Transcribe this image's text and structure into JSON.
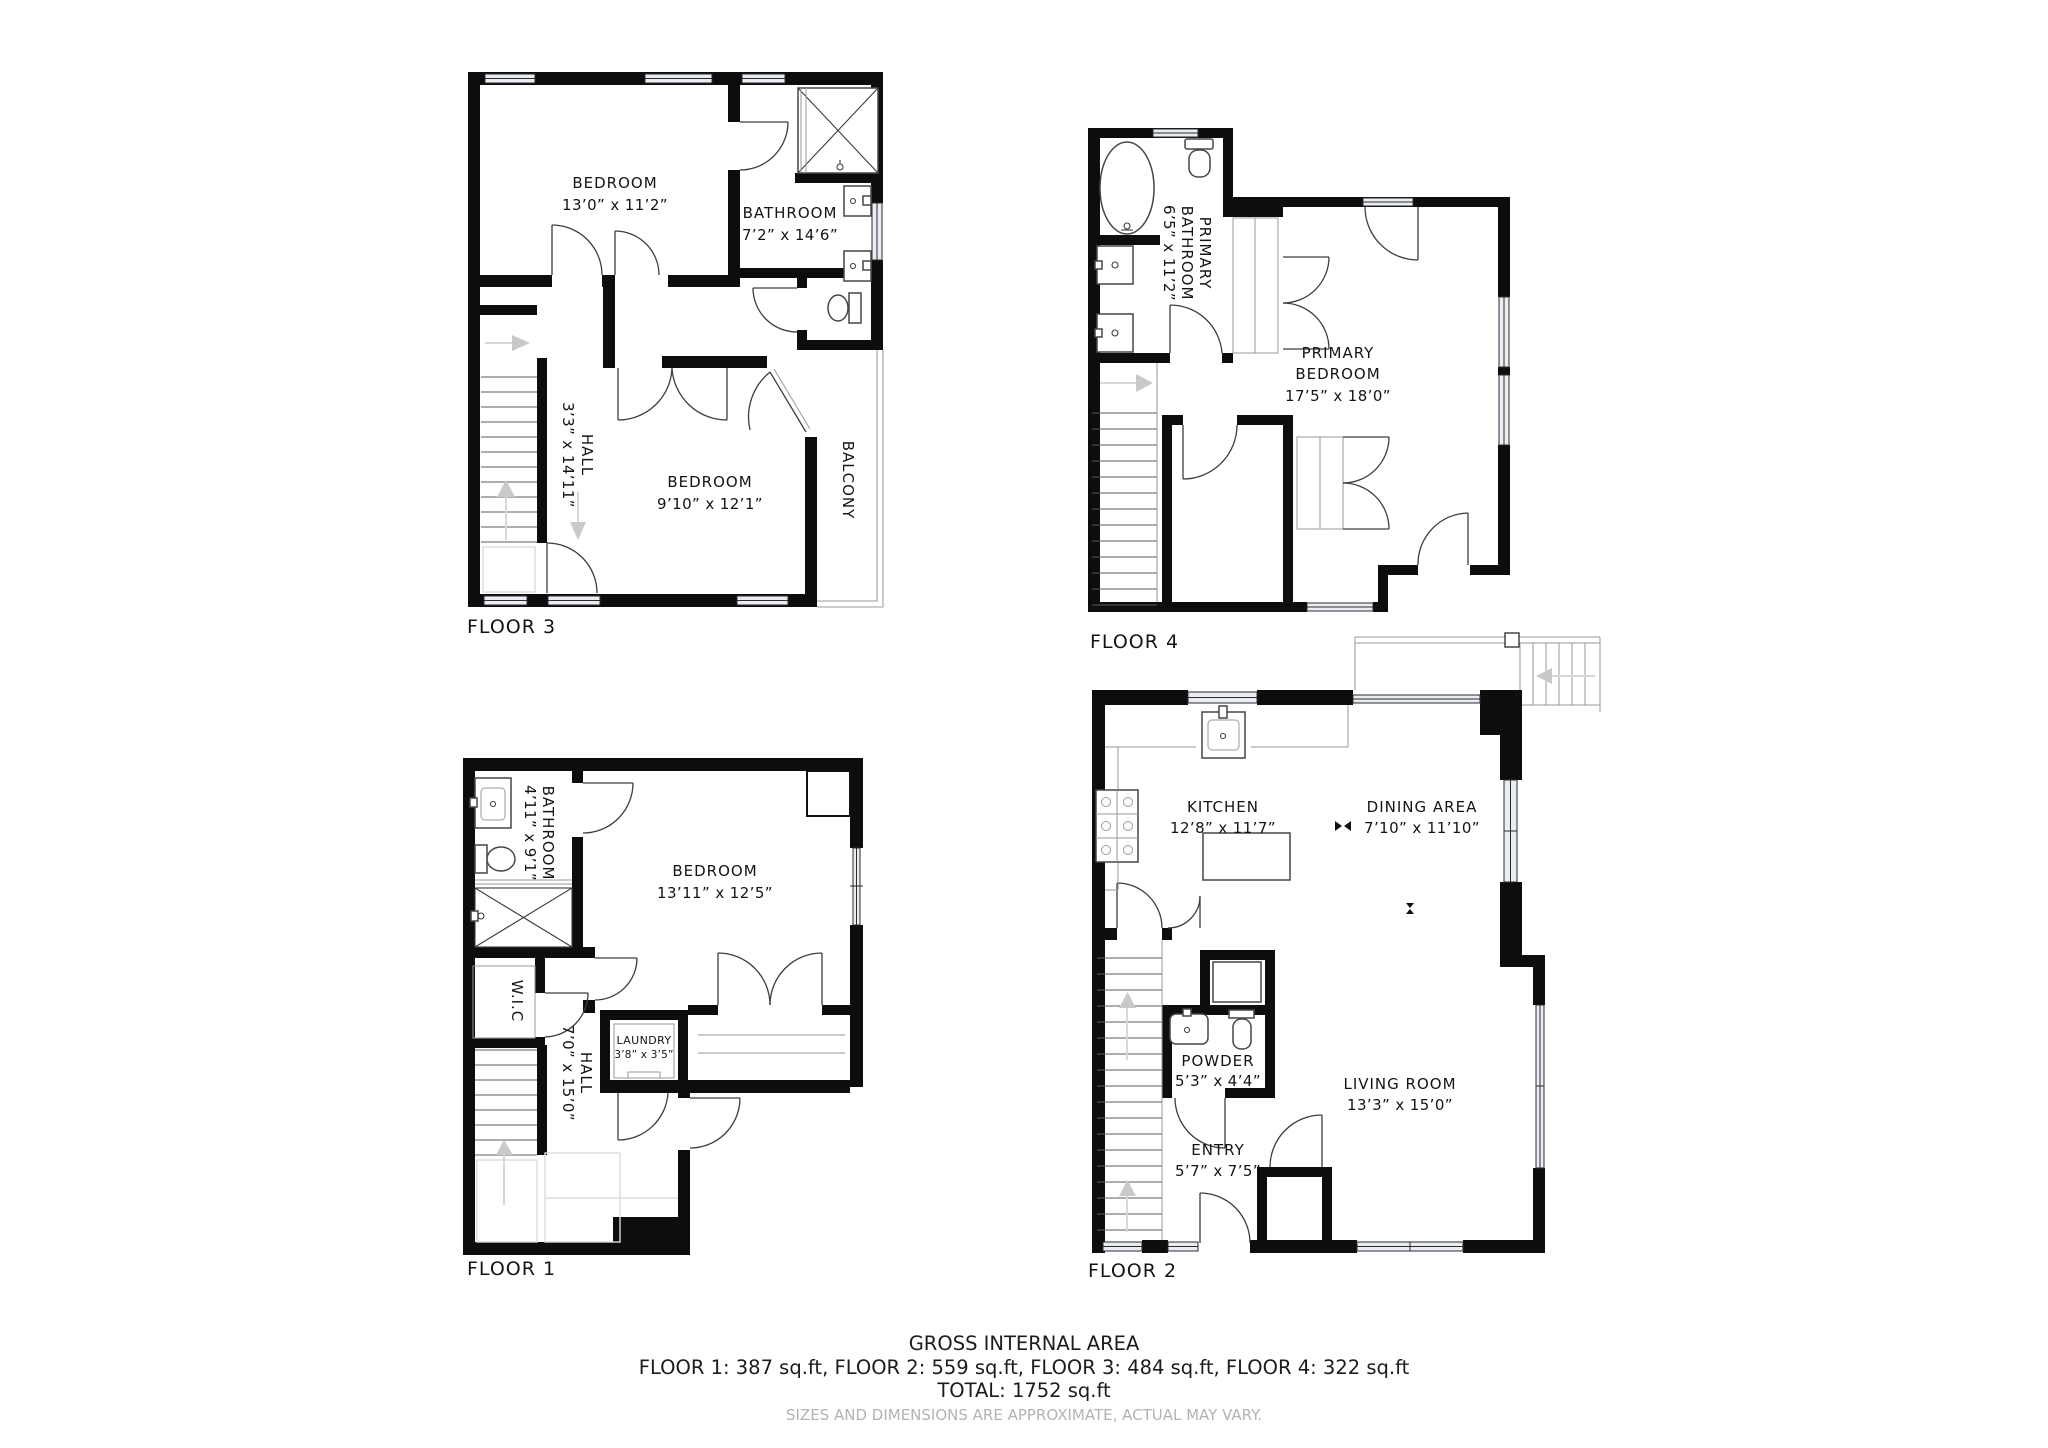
{
  "summary": {
    "title": "GROSS INTERNAL AREA",
    "areas": "FLOOR 1: 387 sq.ft, FLOOR 2: 559 sq.ft, FLOOR 3: 484 sq.ft, FLOOR 4: 322 sq.ft",
    "total": "TOTAL: 1752 sq.ft",
    "disclaimer": "SIZES AND DIMENSIONS ARE APPROXIMATE, ACTUAL MAY VARY."
  },
  "floors": {
    "floor1": {
      "label": "FLOOR 1",
      "rooms": {
        "bathroom": {
          "name": "BATHROOM",
          "dims": "4’11” x 9’1”"
        },
        "bedroom": {
          "name": "BEDROOM",
          "dims": "13’11” x 12’5”"
        },
        "wic": {
          "name": "W.I.C"
        },
        "hall": {
          "name": "HALL",
          "dims": "7’0” x 15’0”"
        },
        "laundry": {
          "name": "LAUNDRY",
          "dims": "3’8” x 3’5”"
        }
      }
    },
    "floor2": {
      "label": "FLOOR 2",
      "rooms": {
        "kitchen": {
          "name": "KITCHEN",
          "dims": "12’8” x 11’7”"
        },
        "dining": {
          "name": "DINING AREA",
          "dims": "7’10” x 11’10”"
        },
        "powder": {
          "name": "POWDER",
          "dims": "5’3” x 4’4”"
        },
        "living": {
          "name": "LIVING ROOM",
          "dims": "13’3” x 15’0”"
        },
        "entry": {
          "name": "ENTRY",
          "dims": "5’7” x 7’5”"
        }
      }
    },
    "floor3": {
      "label": "FLOOR 3",
      "rooms": {
        "bedroom1": {
          "name": "BEDROOM",
          "dims": "13’0” x 11’2”"
        },
        "bathroom": {
          "name": "BATHROOM",
          "dims": "7’2” x 14’6”"
        },
        "hall": {
          "name": "HALL",
          "dims": "3’3” x 14’11”"
        },
        "bedroom2": {
          "name": "BEDROOM",
          "dims": "9’10” x 12’1”"
        },
        "balcony": {
          "name": "BALCONY"
        }
      }
    },
    "floor4": {
      "label": "FLOOR 4",
      "rooms": {
        "primary_bathroom": {
          "name_line1": "PRIMARY",
          "name_line2": "BATHROOM",
          "dims": "6’5” x 11’2”"
        },
        "primary_bedroom": {
          "name_line1": "PRIMARY",
          "name_line2": "BEDROOM",
          "dims": "17’5” x 18’0”"
        }
      }
    }
  }
}
